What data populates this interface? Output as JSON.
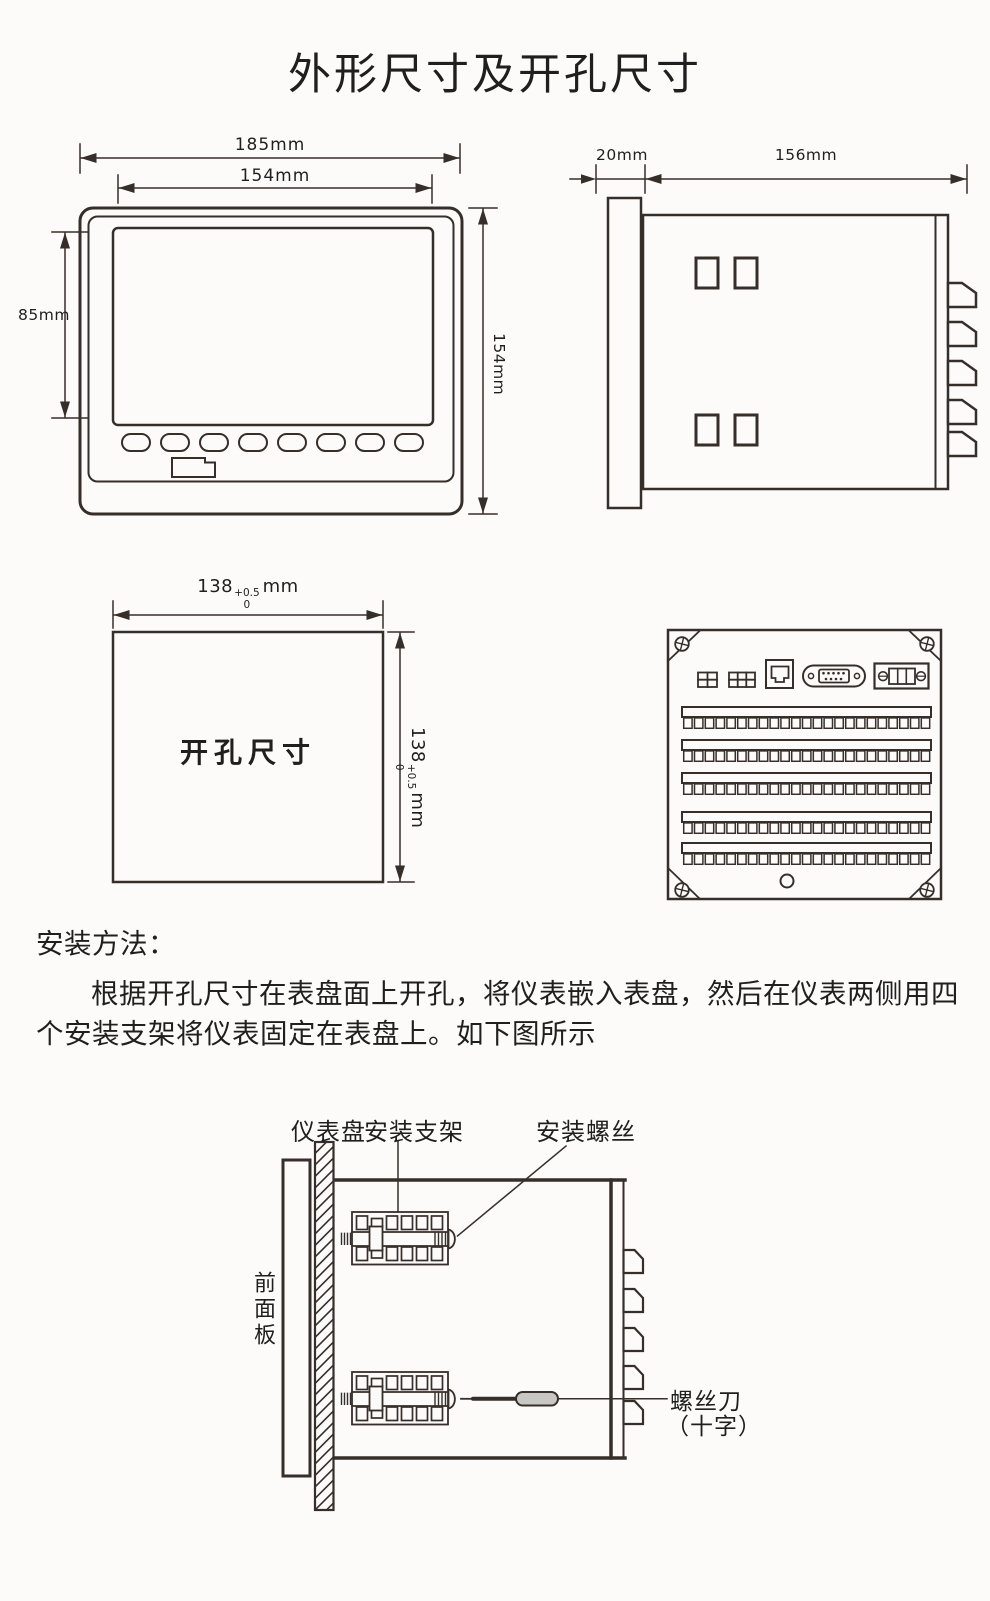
{
  "title": "外形尺寸及开孔尺寸",
  "front_view": {
    "dim_width_outer": "185mm",
    "dim_width_screen": "154mm",
    "dim_height_screen": "85mm",
    "dim_height_outer": "154mm"
  },
  "side_view": {
    "dim_bezel_depth": "20mm",
    "dim_body_depth": "156mm"
  },
  "cutout_view": {
    "label": "开孔尺寸",
    "dim_value": "138",
    "tolerance_upper": "+0.5",
    "tolerance_lower": "0",
    "unit": "mm"
  },
  "instructions": {
    "heading": "安装方法：",
    "lines": [
      "根据开孔尺寸在表盘面上开孔，将仪表嵌入表盘，然后在仪表两侧用四",
      "个安装支架将仪表固定在表盘上。如下图所示"
    ]
  },
  "install_diagram": {
    "label_panel": "仪表盘",
    "label_bracket": "安装支架",
    "label_screw": "安装螺丝",
    "label_front_panel": "前面板",
    "label_screwdriver": "螺丝刀",
    "label_screwdriver_type": "（十字）"
  },
  "colors": {
    "line": "#362e29",
    "text": "#1f1f1f",
    "handle_fill": "#c8c7c4",
    "background": "#fcfbfa"
  }
}
